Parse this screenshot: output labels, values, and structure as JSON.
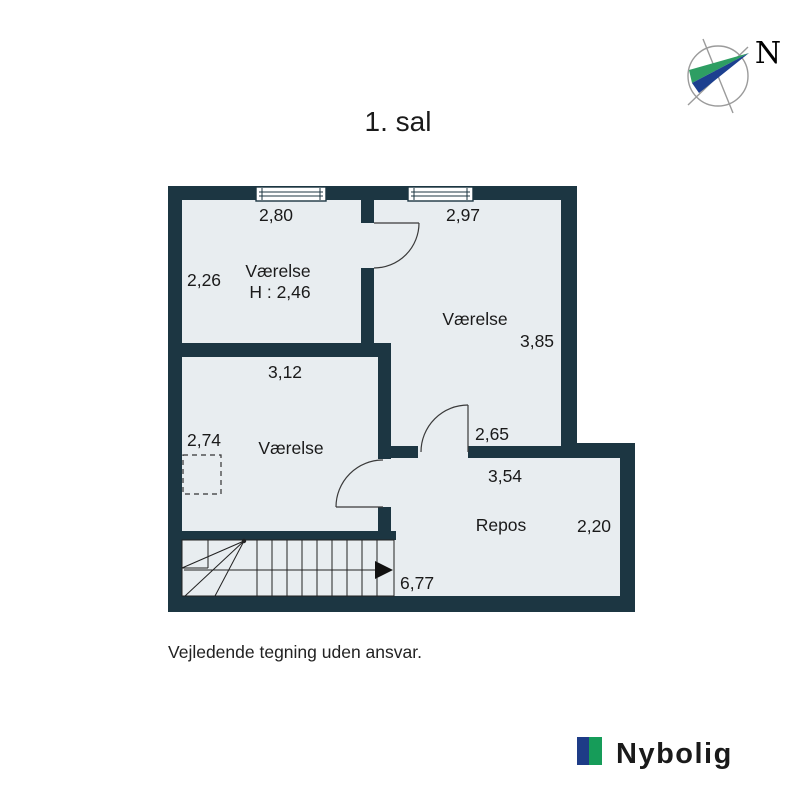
{
  "page": {
    "title": "1. sal",
    "disclaimer": "Vejledende tegning uden ansvar."
  },
  "compass": {
    "north_label": "N"
  },
  "brand": {
    "name": "Nybolig"
  },
  "colors": {
    "wall": "#1c3642",
    "room_fill": "#e8edf0",
    "stairs_fill": "#ffffff",
    "logo_blue": "#1e3c87",
    "logo_green": "#169c59",
    "logo_text": "#b1b2b4",
    "needle_green": "#2e9e63",
    "needle_blue": "#1c3f8f"
  },
  "floorplan": {
    "rooms": {
      "room1": {
        "name": "Værelse",
        "ceiling_height": "H : 2,46",
        "width": "2,80",
        "depth": "2,26"
      },
      "room2": {
        "name": "Værelse",
        "width": "2,97",
        "depth": "3,85",
        "door_wall": "2,65"
      },
      "room3": {
        "name": "Værelse",
        "width": "3,12",
        "depth": "2,74"
      },
      "repos": {
        "name": "Repos",
        "width": "3,54",
        "depth": "2,20"
      }
    },
    "stairs": {
      "run": "6,77"
    }
  }
}
